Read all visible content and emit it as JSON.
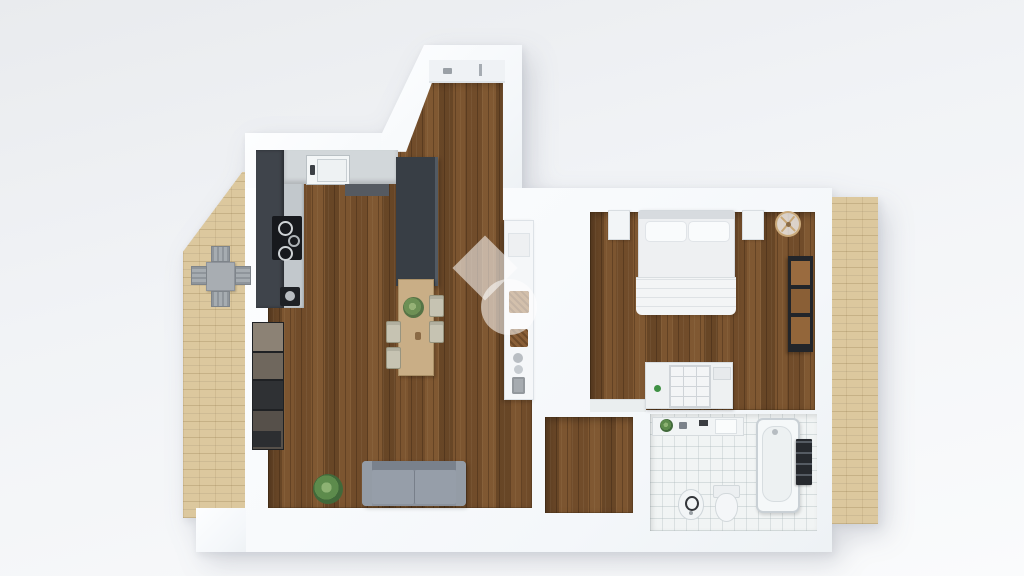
{
  "scene": {
    "view": "3d-floorplan-top-down-render",
    "watermark": "semi-transparent white diamond and circle logo, center of plan",
    "background_color": "#f0f2f5"
  },
  "palette": {
    "wall_white": "#fbfcfe",
    "wood_floor_brown": "#7b5531",
    "bathroom_tile": "#f1f4f4",
    "patio_tan": "#dcc89e",
    "dark_cabinet_gray": "#3f444b",
    "countertop_gray": "#d2d7da",
    "sofa_gray": "#8a929d",
    "plant_green": "#5d8b4c",
    "shelf_wood_brown": "#9a6b3f",
    "dining_table_wood": "#c9ae86",
    "lamp_gold": "#c9a877",
    "dresser_knob_green": "#3f9144"
  },
  "rooms": {
    "kitchen_living": {
      "label": "open kitchen and living room",
      "objects": [
        "wall counter with sink",
        "cooktop with burners",
        "coffee machine",
        "tall dark cabinet column",
        "dining table with plant and four chairs",
        "storage shelf boxes on left wall",
        "white bookshelf with baskets and vases",
        "gray sofa",
        "potted floor plant",
        "bay niche with sill"
      ]
    },
    "bedroom": {
      "label": "bedroom",
      "objects": [
        "double bed with two pillows and folded blanket",
        "left nightstand",
        "right nightstand",
        "round ceiling lamp",
        "dark wall shelving with wood shelves",
        "white dresser with drawer grid and green knob",
        "low bench"
      ]
    },
    "bathroom": {
      "label": "bathroom",
      "objects": [
        "vanity with faucet and plant",
        "bathtub",
        "toilet",
        "bidet",
        "dark radiator"
      ]
    },
    "hallway": {
      "label": "hallway",
      "objects": []
    },
    "patio": {
      "label": "outdoor patio with tan paving",
      "objects": [
        "square gray table",
        "four gray chairs"
      ]
    },
    "balcony_strip": {
      "label": "tan paved strip on right side",
      "objects": []
    }
  }
}
